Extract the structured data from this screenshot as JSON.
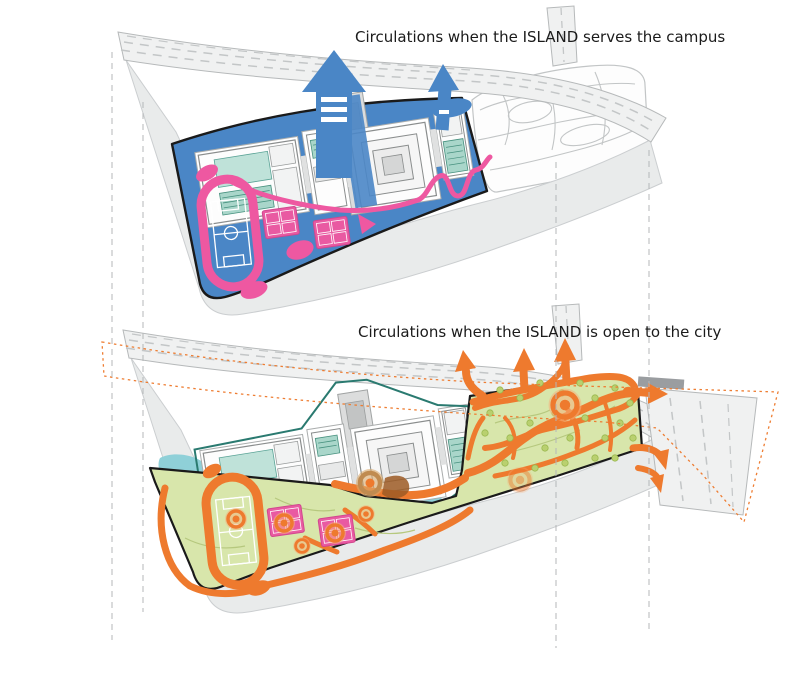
{
  "canvas": {
    "width": 800,
    "height": 677,
    "background": "#ffffff"
  },
  "diagrams": [
    {
      "id": "campus-mode",
      "title": "Circulations when the ISLAND serves the campus",
      "palette": {
        "circulation": "#4a86c6",
        "sports": "#ee58a1",
        "courtyard": "#a9d6ca",
        "site_outline": "#1a1a1a",
        "road": "#f0f1f1",
        "ground": "#e9ebeb"
      },
      "icons": [
        "arrow-up-icon"
      ]
    },
    {
      "id": "city-mode",
      "title": "Circulations when the ISLAND is open to the city",
      "palette": {
        "circulation": "#ee7a2e",
        "landscape": "#d8e6ab",
        "water": "#8fd0d8",
        "campus_outline": "#2a7a70",
        "sports_court": "#e95aa2",
        "site_outline": "#1a1a1a",
        "open_boundary_dashed": "#ee7d32"
      },
      "icons": [
        "arrow-up-icon",
        "arrow-right-icon",
        "arrow-hook-icon",
        "entry-node-icon"
      ]
    }
  ]
}
